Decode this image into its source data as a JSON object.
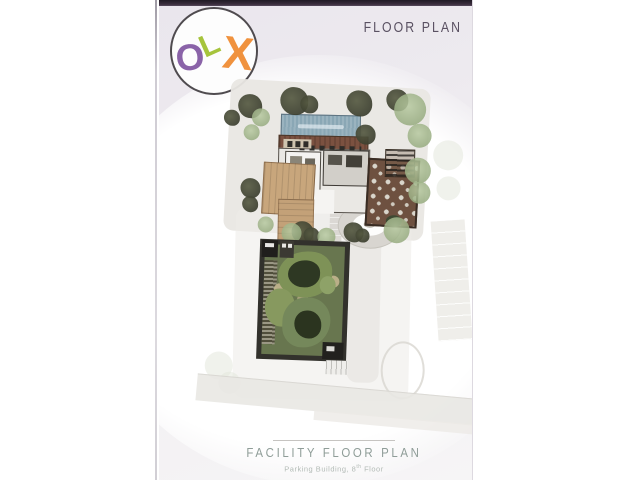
{
  "logo": {
    "name": "OLX",
    "letters": [
      {
        "char": "O",
        "color_key": "logo-o"
      },
      {
        "char": "L",
        "color_key": "logo-l"
      },
      {
        "char": "X",
        "color_key": "logo-x"
      }
    ]
  },
  "header": {
    "title": "FLOOR PLAN"
  },
  "footer": {
    "title": "FACILITY FLOOR PLAN",
    "subtitle_prefix": "Parking Building, 8",
    "subtitle_sup": "th",
    "subtitle_suffix": " Floor"
  },
  "colors": {
    "top-strip": "#3a2d3d",
    "logo-o": "#8a63a8",
    "logo-l": "#a6c43c",
    "logo-x": "#f0923e",
    "header-text": "#5a5162",
    "footer-title": "#8f9d98",
    "footer-subtitle": "#b3bbb6",
    "pool": "#8aa7b5",
    "deck": "#7b5140",
    "wood": "#c8a67c",
    "tree": "#3b3e2e",
    "bush": "#93a87c",
    "garden-frame": "#32312c",
    "garden-green": "#68764f"
  }
}
